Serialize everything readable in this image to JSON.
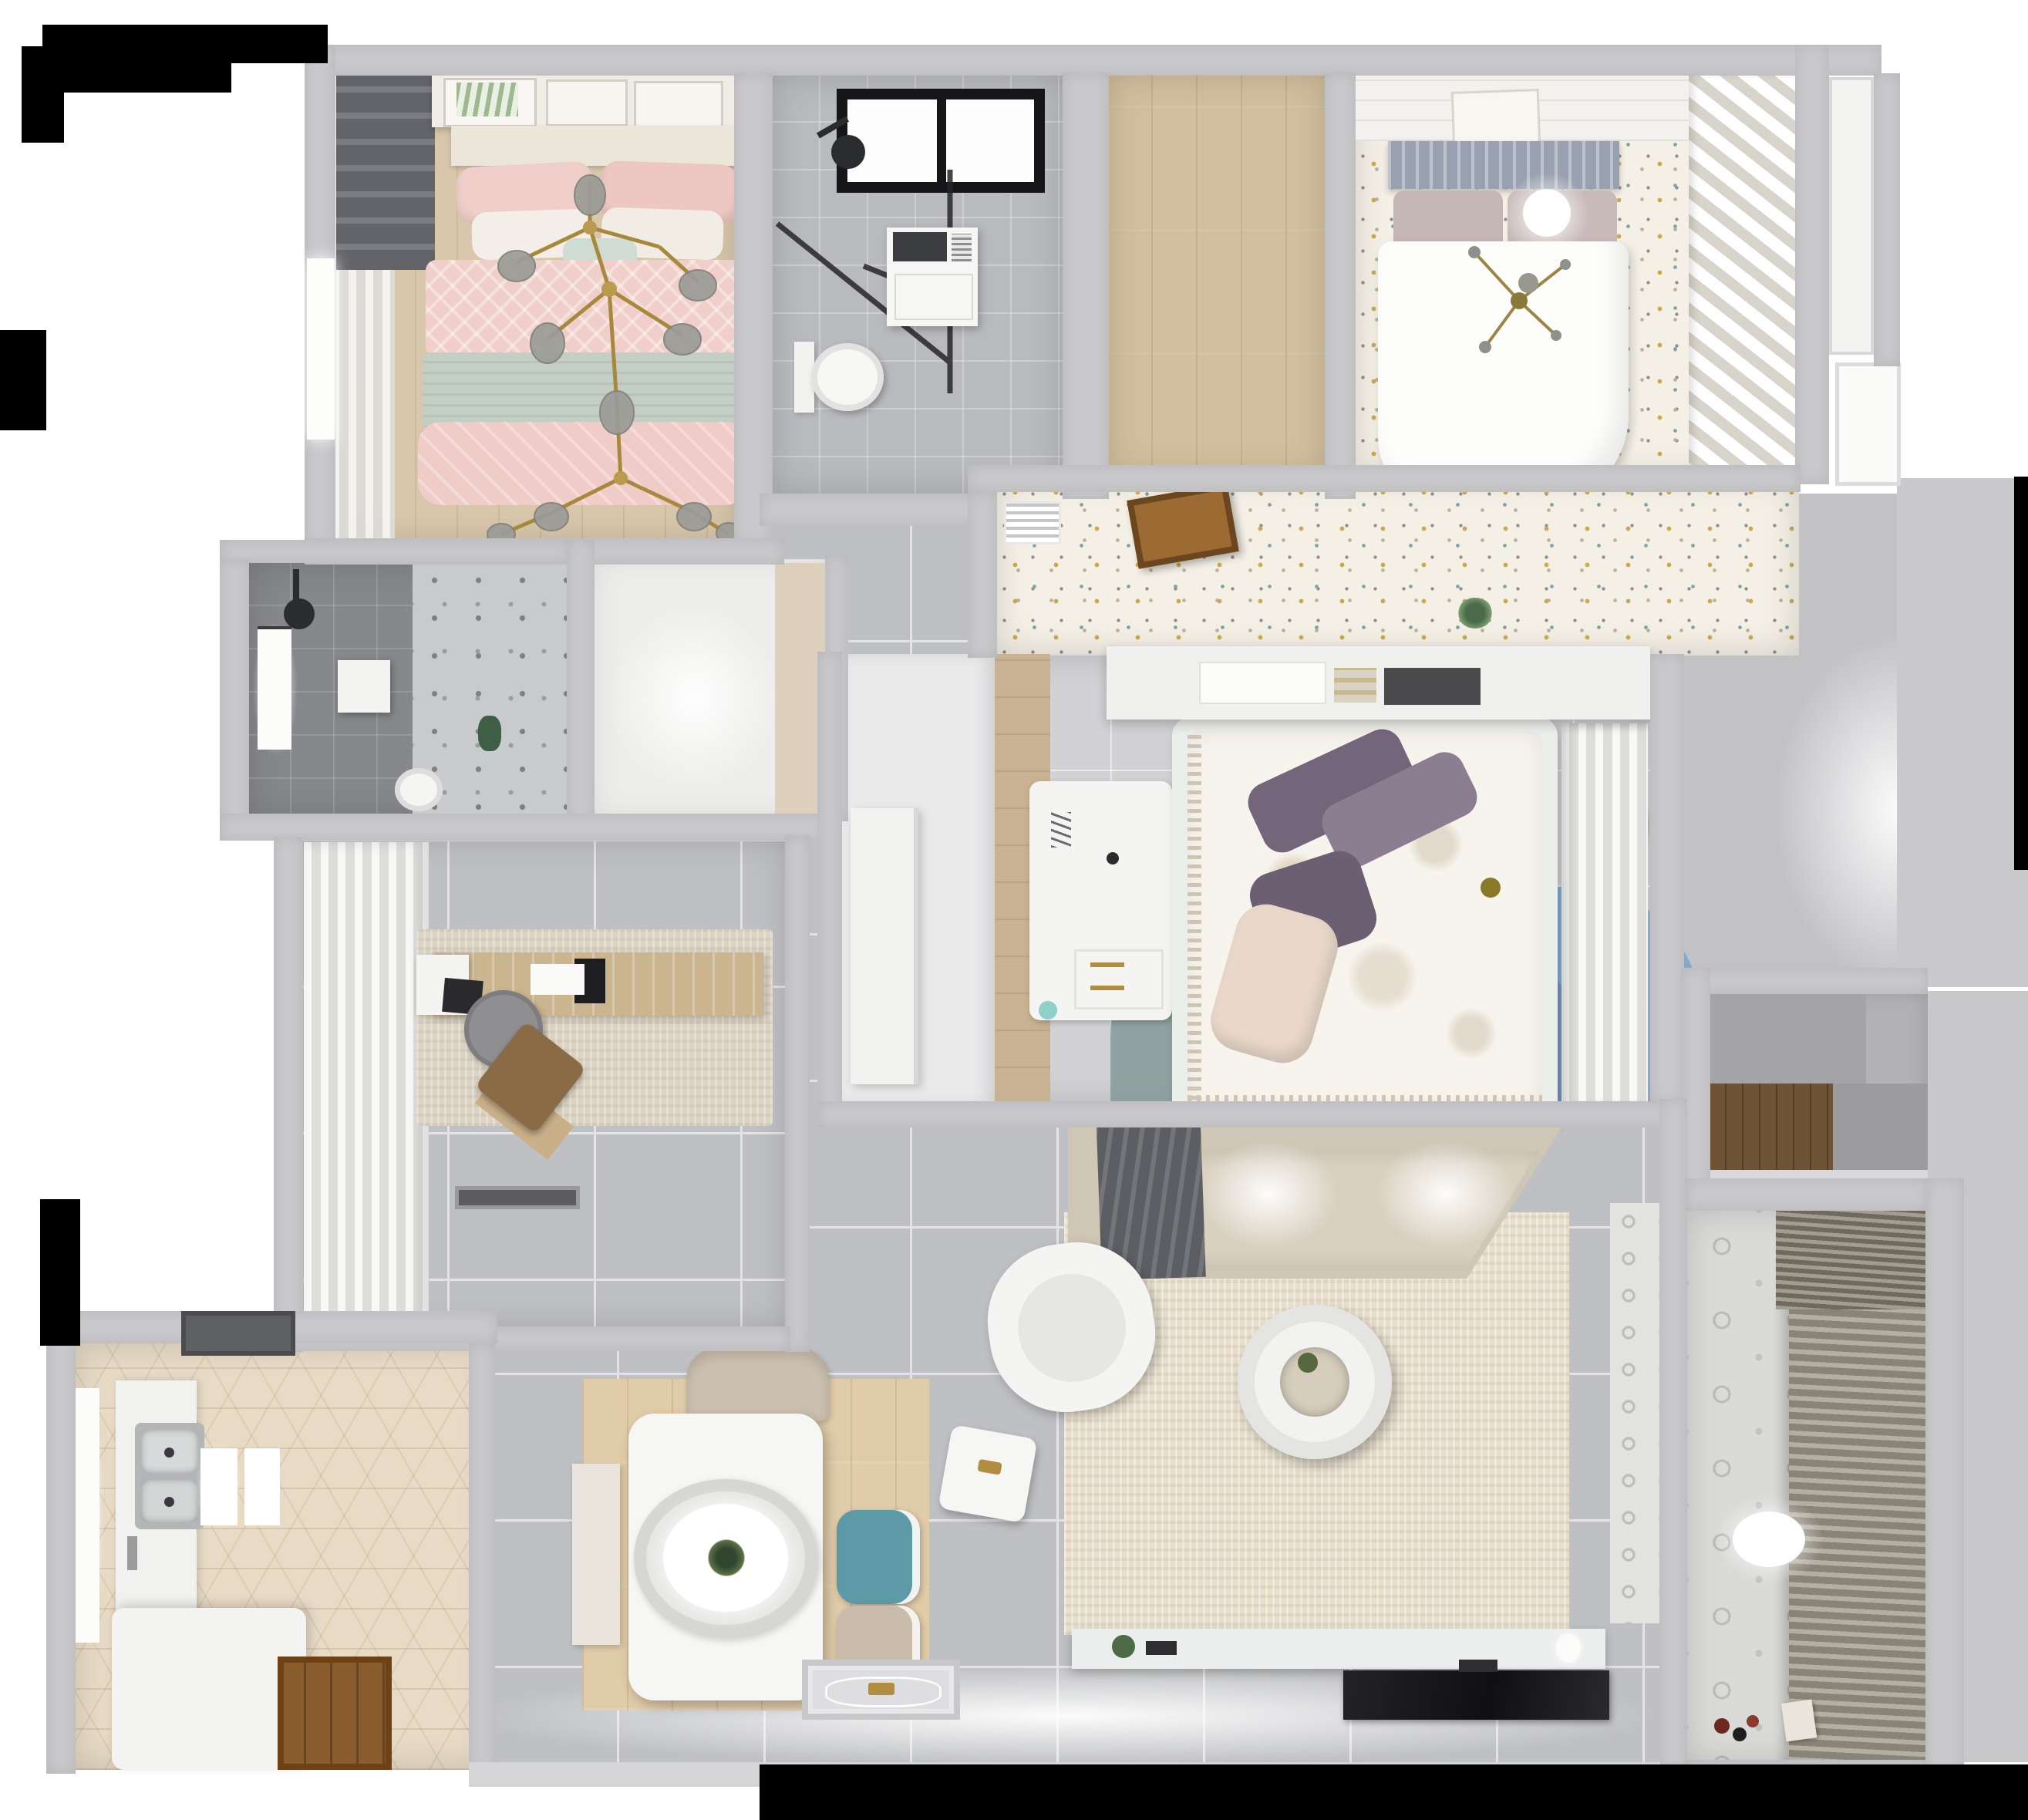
{
  "scene": {
    "type": "3d-apartment-floorplan-top-view",
    "title": "Apartment 3D floor plan (top-down render)",
    "style": "photoreal dollhouse render, no visible text labels"
  },
  "rooms": [
    {
      "id": "pink-bedroom",
      "label": "Bedroom with pink bedding"
    },
    {
      "id": "bathroom-top",
      "label": "Bathroom with shower and washer"
    },
    {
      "id": "walk-in",
      "label": "Empty walk-in / storage room"
    },
    {
      "id": "kids-bedroom",
      "label": "Bedroom with white bed and speckled floor"
    },
    {
      "id": "suite-hall",
      "label": "Suite hallway with open door"
    },
    {
      "id": "shower-room",
      "label": "Dark tiled shower room"
    },
    {
      "id": "utility-niche",
      "label": "Bright utility niche"
    },
    {
      "id": "study",
      "label": "Study with desk and curtains"
    },
    {
      "id": "hallway",
      "label": "Central tiled hallway"
    },
    {
      "id": "kitchen",
      "label": "Kitchen with hexagonal tile floor"
    },
    {
      "id": "dining",
      "label": "Dining area"
    },
    {
      "id": "living",
      "label": "Living room"
    },
    {
      "id": "master-bedroom",
      "label": "Master bedroom with floral duvet"
    },
    {
      "id": "storage-niche",
      "label": "Storage niche with wood counter"
    },
    {
      "id": "balcony",
      "label": "Balcony / laundry with blinds"
    },
    {
      "id": "entry",
      "label": "Entry with ornamental doormat"
    }
  ],
  "furniture": {
    "pink_bedroom": [
      "double bed with pink duvet",
      "pink and white pillows",
      "sage blanket band",
      "gold branch chandelier",
      "three wall art frames",
      "dark roman shade",
      "sheer curtain wall",
      "window"
    ],
    "bathroom_top": [
      "black framed skylight",
      "black shower head",
      "glass shower screen",
      "washing machine",
      "toilet"
    ],
    "kids_bedroom": [
      "bed with gray slatted headboard",
      "mauve pillows",
      "white duvet",
      "round ceiling light",
      "gold sputnik lamp",
      "wall art frame",
      "diagonal white shelving",
      "louvered vent",
      "open wooden door"
    ],
    "shower_room": [
      "window",
      "black shower head",
      "white shower tray",
      "marble floor half",
      "toilet",
      "green plant"
    ],
    "study": [
      "sheer curtain wall",
      "beige area rug",
      "wooden desk",
      "desk monitor",
      "laptop",
      "round gray chair",
      "brown lounge chair",
      "dark doormat"
    ],
    "master_bedroom": [
      "headboard shelf with books",
      "double bed with floral duvet",
      "purple pillows",
      "cream pillow",
      "white desk",
      "two teal poufs",
      "circle rug in blue mauve teal",
      "white curtain wardrobe",
      "wood closet floor strip"
    ],
    "kitchen": [
      "range hood",
      "double stainless sink",
      "white counters",
      "two bright trays",
      "white island counter",
      "wooden entry floor",
      "window"
    ],
    "dining": [
      "white dining table",
      "oval pendant lamp with plant",
      "beige chair",
      "teal chair",
      "beige chair",
      "white bench",
      "light wood rug"
    ],
    "living": [
      "beige corner sofa",
      "gray throw",
      "beige rug",
      "round donut coffee table",
      "white armchair",
      "white side stool",
      "TV console with plant",
      "flat TV panel"
    ],
    "balcony": [
      "venetian blinds",
      "patterned tile floor",
      "ceiling light",
      "small toys",
      "storage box"
    ],
    "entry": [
      "ornamental doormat with gold crest"
    ]
  },
  "colors": {
    "wall": "#c9c9cc",
    "floor_tile": "#bfc0c3",
    "grout": "#e3e3e5",
    "bath_tile": "#b8babd",
    "dark_tile": "#85878b",
    "wood_light": "#d8c7ab",
    "wood_plank": "#d2bf9e",
    "wood_closet": "#c8b291",
    "speckle_base": "#f4f0e6",
    "hex_tile": "#e7dbc6",
    "rug_beige": "#dcd3c2",
    "sofa_beige": "#cfc6b5",
    "pink_bed": "#f0cfca",
    "sage_blanket": "#c3cec4",
    "purple_pillow": "#74657a",
    "teal_chair": "#5b9aa6",
    "pouf_teal": "#cfe0df",
    "rug_blue": "#6f9fcb",
    "rug_mauve": "#8d7382",
    "rug_tealgray": "#7e9694",
    "gold": "#ab8a3f",
    "tv_black": "#17181a",
    "blinds_dark": "#8a8478",
    "blinds_light": "#b5afa3",
    "door_wood": "#9c6a33",
    "black_patch": "#000000"
  }
}
